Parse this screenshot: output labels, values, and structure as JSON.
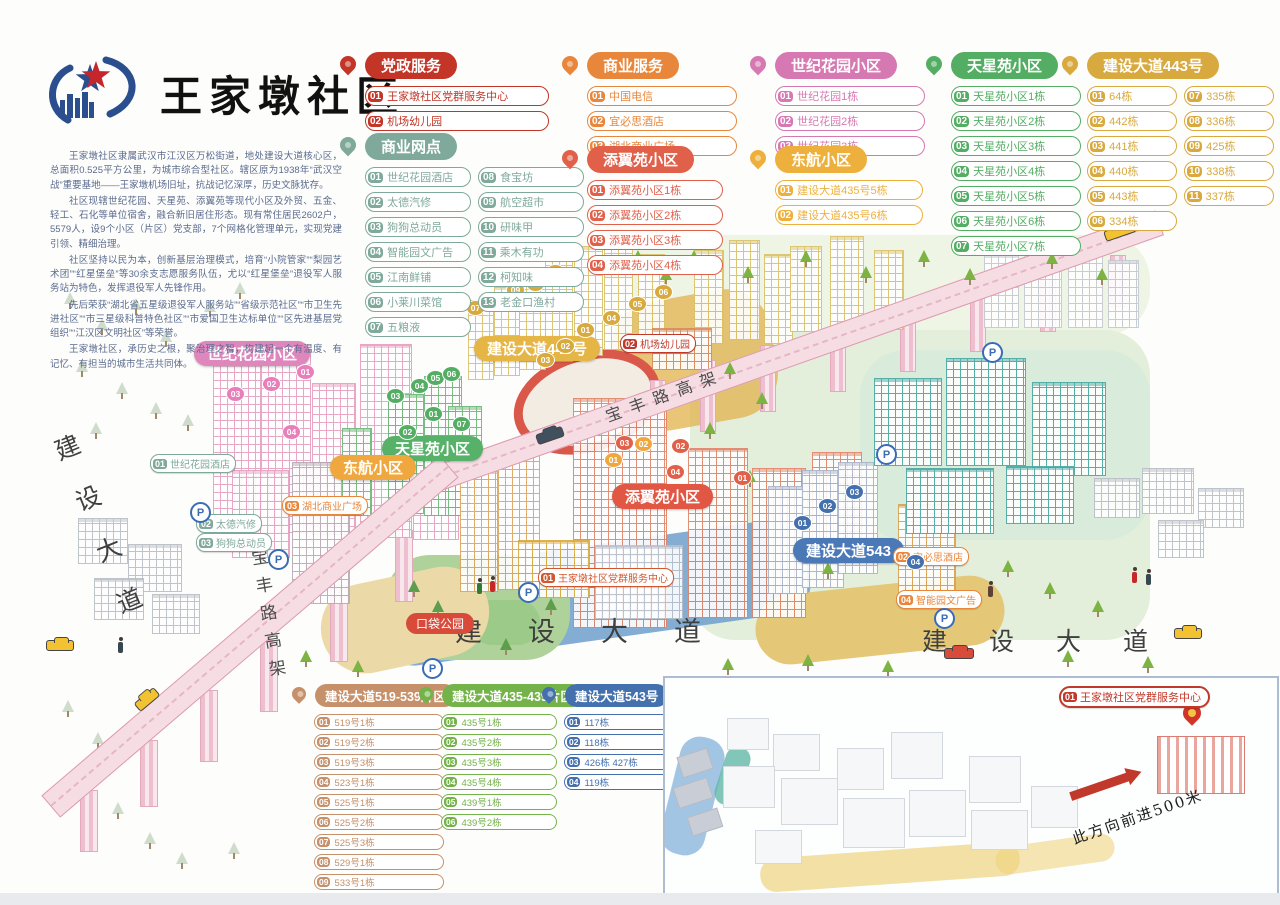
{
  "title": {
    "community_name": "王家墩社区"
  },
  "intro": {
    "paragraphs": [
      "王家墩社区隶属武汉市江汉区万松街道，地处建设大道核心区，总面积0.525平方公里，为城市综合型社区。辖区原为1938年“武汉空战”重要基地——王家墩机场旧址，抗战记忆深厚，历史文脉犹存。",
      "社区现辖世纪花园、天星苑、添翼苑等现代小区及外贸、五金、轻工、石化等单位宿舍，融合新旧居住形态。现有常住居民2602户，5579人，设9个小区（片区）党支部，7个网格化管理单元，实现党建引领、精细治理。",
      "社区坚持以民为本，创新基层治理模式，培育“小院管家”“梨园艺术团”“红星堡垒”等30余支志愿服务队伍，尤以“红星堡垒”退役军人服务站为特色，发挥退役军人先锋作用。",
      "先后荣获“湖北省五星级退役军人服务站”“省级示范社区”“市卫生先进社区”“市三星级科普特色社区”“市爱国卫生达标单位”“区先进基层党组织”“江汉区文明社区”等荣誉。",
      "王家墩社区，承历史之根，聚治理之智，构建起一个有温度、有记忆、有担当的城市生活共同体。"
    ]
  },
  "legend_panels": [
    {
      "title": "党政服务",
      "color": "#c23527",
      "items": [
        {
          "num": "01",
          "label": "王家墩社区党群服务中心"
        },
        {
          "num": "02",
          "label": "机场幼儿园"
        }
      ]
    },
    {
      "title": "商业网点",
      "color": "#7fa99b",
      "items": [
        {
          "num": "01",
          "label": "世纪花园酒店"
        },
        {
          "num": "02",
          "label": "太德汽修"
        },
        {
          "num": "03",
          "label": "狗狗总动员"
        },
        {
          "num": "04",
          "label": "智能园文广告"
        },
        {
          "num": "05",
          "label": "江南鲜铺"
        },
        {
          "num": "06",
          "label": "小莱川菜馆"
        },
        {
          "num": "07",
          "label": "五粮液"
        },
        {
          "num": "08",
          "label": "食宝坊"
        },
        {
          "num": "09",
          "label": "航空超市"
        },
        {
          "num": "10",
          "label": "研味甲"
        },
        {
          "num": "11",
          "label": "乘木有功"
        },
        {
          "num": "12",
          "label": "柯知味"
        },
        {
          "num": "13",
          "label": "老金口渔村"
        }
      ]
    },
    {
      "title": "商业服务",
      "color": "#e8873b",
      "items": [
        {
          "num": "01",
          "label": "中国电信"
        },
        {
          "num": "02",
          "label": "宜必思酒店"
        },
        {
          "num": "03",
          "label": "湖北商业广场"
        }
      ]
    },
    {
      "title": "添翼苑小区",
      "color": "#e0604a",
      "items": [
        {
          "num": "01",
          "label": "添翼苑小区1栋"
        },
        {
          "num": "02",
          "label": "添翼苑小区2栋"
        },
        {
          "num": "03",
          "label": "添翼苑小区3栋"
        },
        {
          "num": "04",
          "label": "添翼苑小区4栋"
        }
      ]
    },
    {
      "title": "世纪花园小区",
      "color": "#d678b2",
      "items": [
        {
          "num": "01",
          "label": "世纪花园1栋"
        },
        {
          "num": "02",
          "label": "世纪花园2栋"
        },
        {
          "num": "03",
          "label": "世纪花园3栋"
        }
      ]
    },
    {
      "title": "东航小区",
      "color": "#eeb03c",
      "items": [
        {
          "num": "01",
          "label": "建设大道435号5栋"
        },
        {
          "num": "02",
          "label": "建设大道435号6栋"
        }
      ]
    },
    {
      "title": "天星苑小区",
      "color": "#53ad63",
      "items": [
        {
          "num": "01",
          "label": "天星苑小区1栋"
        },
        {
          "num": "02",
          "label": "天星苑小区2栋"
        },
        {
          "num": "03",
          "label": "天星苑小区3栋"
        },
        {
          "num": "04",
          "label": "天星苑小区4栋"
        },
        {
          "num": "05",
          "label": "天星苑小区5栋"
        },
        {
          "num": "06",
          "label": "天星苑小区6栋"
        },
        {
          "num": "07",
          "label": "天星苑小区7栋"
        }
      ]
    },
    {
      "title": "建设大道443号",
      "color": "#d8a93e",
      "items": [
        {
          "num": "01",
          "label": "64栋"
        },
        {
          "num": "02",
          "label": "442栋"
        },
        {
          "num": "03",
          "label": "441栋"
        },
        {
          "num": "04",
          "label": "440栋"
        },
        {
          "num": "05",
          "label": "443栋"
        },
        {
          "num": "06",
          "label": "334栋"
        },
        {
          "num": "07",
          "label": "335栋"
        },
        {
          "num": "08",
          "label": "336栋"
        },
        {
          "num": "09",
          "label": "425栋"
        },
        {
          "num": "10",
          "label": "338栋"
        },
        {
          "num": "11",
          "label": "337栋"
        }
      ]
    },
    {
      "title": "建设大道519-539片区",
      "color": "#c6906a",
      "items": [
        {
          "num": "01",
          "label": "519号1栋"
        },
        {
          "num": "02",
          "label": "519号2栋"
        },
        {
          "num": "03",
          "label": "519号3栋"
        },
        {
          "num": "04",
          "label": "523号1栋"
        },
        {
          "num": "05",
          "label": "525号1栋"
        },
        {
          "num": "06",
          "label": "525号2栋"
        },
        {
          "num": "07",
          "label": "525号3栋"
        },
        {
          "num": "08",
          "label": "529号1栋"
        },
        {
          "num": "09",
          "label": "533号1栋"
        },
        {
          "num": "10",
          "label": "539号1栋"
        }
      ]
    },
    {
      "title": "建设大道435-439片区",
      "color": "#74b24a",
      "items": [
        {
          "num": "01",
          "label": "435号1栋"
        },
        {
          "num": "02",
          "label": "435号2栋"
        },
        {
          "num": "03",
          "label": "435号3栋"
        },
        {
          "num": "04",
          "label": "435号4栋"
        },
        {
          "num": "05",
          "label": "439号1栋"
        },
        {
          "num": "06",
          "label": "439号2栋"
        }
      ]
    },
    {
      "title": "建设大道543号",
      "color": "#4470ad",
      "items": [
        {
          "num": "01",
          "label": "117栋"
        },
        {
          "num": "02",
          "label": "118栋"
        },
        {
          "num": "03",
          "label": "426栋 427栋"
        },
        {
          "num": "04",
          "label": "119栋"
        }
      ]
    }
  ],
  "map": {
    "road_label": "建设大道",
    "viaduct_label": "宝丰路高架",
    "ribbons": [
      {
        "label": "世纪花园小区",
        "color": "#df87bd",
        "x": 194,
        "y": 341
      },
      {
        "label": "建设大道443号",
        "color": "#e5b546",
        "x": 474,
        "y": 336
      },
      {
        "label": "天星苑小区",
        "color": "#58b168",
        "x": 382,
        "y": 436
      },
      {
        "label": "东航小区",
        "color": "#f0a83e",
        "x": 330,
        "y": 455
      },
      {
        "label": "添翼苑小区",
        "color": "#e25744",
        "x": 612,
        "y": 484
      },
      {
        "label": "建设大道543",
        "color": "#4b79b7",
        "x": 793,
        "y": 538
      }
    ],
    "tags": [
      {
        "num": "02",
        "label": "机场幼儿园",
        "color": "#c0392b",
        "x": 620,
        "y": 334
      },
      {
        "num": "01",
        "label": "世纪花园酒店",
        "color": "#7fa99b",
        "x": 150,
        "y": 454
      },
      {
        "num": "02",
        "label": "太德汽修",
        "color": "#7fa99b",
        "x": 196,
        "y": 514
      },
      {
        "num": "03",
        "label": "狗狗总动员",
        "color": "#7fa99b",
        "x": 196,
        "y": 533
      },
      {
        "num": "03",
        "label": "湖北商业广场",
        "color": "#e8873b",
        "x": 282,
        "y": 496
      },
      {
        "num": "01",
        "label": "王家墩社区党群服务中心",
        "color": "#d2572f",
        "x": 538,
        "y": 568
      },
      {
        "num": "02",
        "label": "宜必思酒店",
        "color": "#e8873b",
        "x": 893,
        "y": 547
      },
      {
        "num": "04",
        "label": "智能园文广告",
        "color": "#e8873b",
        "x": 896,
        "y": 590
      }
    ],
    "plain_labels": [
      {
        "label": "口袋公园",
        "color": "#d84b3a",
        "x": 406,
        "y": 613
      }
    ],
    "badges": [
      {
        "label": "01",
        "color": "#e87fbb",
        "x": 296,
        "y": 364
      },
      {
        "label": "02",
        "color": "#e87fbb",
        "x": 262,
        "y": 376
      },
      {
        "label": "03",
        "color": "#e87fbb",
        "x": 226,
        "y": 386
      },
      {
        "label": "04",
        "color": "#e87fbb",
        "x": 282,
        "y": 424
      },
      {
        "label": "01",
        "color": "#53ad63",
        "x": 424,
        "y": 406
      },
      {
        "label": "02",
        "color": "#53ad63",
        "x": 398,
        "y": 424
      },
      {
        "label": "03",
        "color": "#53ad63",
        "x": 386,
        "y": 388
      },
      {
        "label": "04",
        "color": "#53ad63",
        "x": 410,
        "y": 378
      },
      {
        "label": "05",
        "color": "#53ad63",
        "x": 426,
        "y": 370
      },
      {
        "label": "06",
        "color": "#53ad63",
        "x": 442,
        "y": 366
      },
      {
        "label": "07",
        "color": "#53ad63",
        "x": 452,
        "y": 416
      },
      {
        "label": "01",
        "color": "#d8a93e",
        "x": 576,
        "y": 322
      },
      {
        "label": "02",
        "color": "#d8a93e",
        "x": 556,
        "y": 338
      },
      {
        "label": "03",
        "color": "#d8a93e",
        "x": 536,
        "y": 352
      },
      {
        "label": "04",
        "color": "#d8a93e",
        "x": 602,
        "y": 310
      },
      {
        "label": "05",
        "color": "#d8a93e",
        "x": 628,
        "y": 296
      },
      {
        "label": "06",
        "color": "#d8a93e",
        "x": 654,
        "y": 284
      },
      {
        "label": "07",
        "color": "#d8a93e",
        "x": 466,
        "y": 300
      },
      {
        "label": "08",
        "color": "#d8a93e",
        "x": 490,
        "y": 296
      },
      {
        "label": "09",
        "color": "#d8a93e",
        "x": 506,
        "y": 282
      },
      {
        "label": "10",
        "color": "#d8a93e",
        "x": 526,
        "y": 276
      },
      {
        "label": "11",
        "color": "#d8a93e",
        "x": 546,
        "y": 264
      },
      {
        "label": "01",
        "color": "#e0604a",
        "x": 733,
        "y": 470
      },
      {
        "label": "02",
        "color": "#e0604a",
        "x": 671,
        "y": 438
      },
      {
        "label": "03",
        "color": "#e0604a",
        "x": 615,
        "y": 435
      },
      {
        "label": "04",
        "color": "#e0604a",
        "x": 666,
        "y": 464
      },
      {
        "label": "01",
        "color": "#4470ad",
        "x": 793,
        "y": 515
      },
      {
        "label": "02",
        "color": "#4470ad",
        "x": 818,
        "y": 498
      },
      {
        "label": "03",
        "color": "#4470ad",
        "x": 845,
        "y": 484
      },
      {
        "label": "04",
        "color": "#4470ad",
        "x": 906,
        "y": 554
      },
      {
        "label": "01",
        "color": "#f0a83e",
        "x": 604,
        "y": 452
      },
      {
        "label": "02",
        "color": "#f0a83e",
        "x": 634,
        "y": 436
      }
    ],
    "parking": {
      "letter": "P",
      "spots": [
        {
          "x": 190,
          "y": 502
        },
        {
          "x": 268,
          "y": 549
        },
        {
          "x": 422,
          "y": 658
        },
        {
          "x": 518,
          "y": 582
        },
        {
          "x": 876,
          "y": 444
        },
        {
          "x": 982,
          "y": 342
        },
        {
          "x": 934,
          "y": 608
        }
      ]
    }
  },
  "inset": {
    "tag": {
      "num": "01",
      "label": "王家墩社区党群服务中心"
    },
    "direction_text": "此方向前进500米"
  }
}
